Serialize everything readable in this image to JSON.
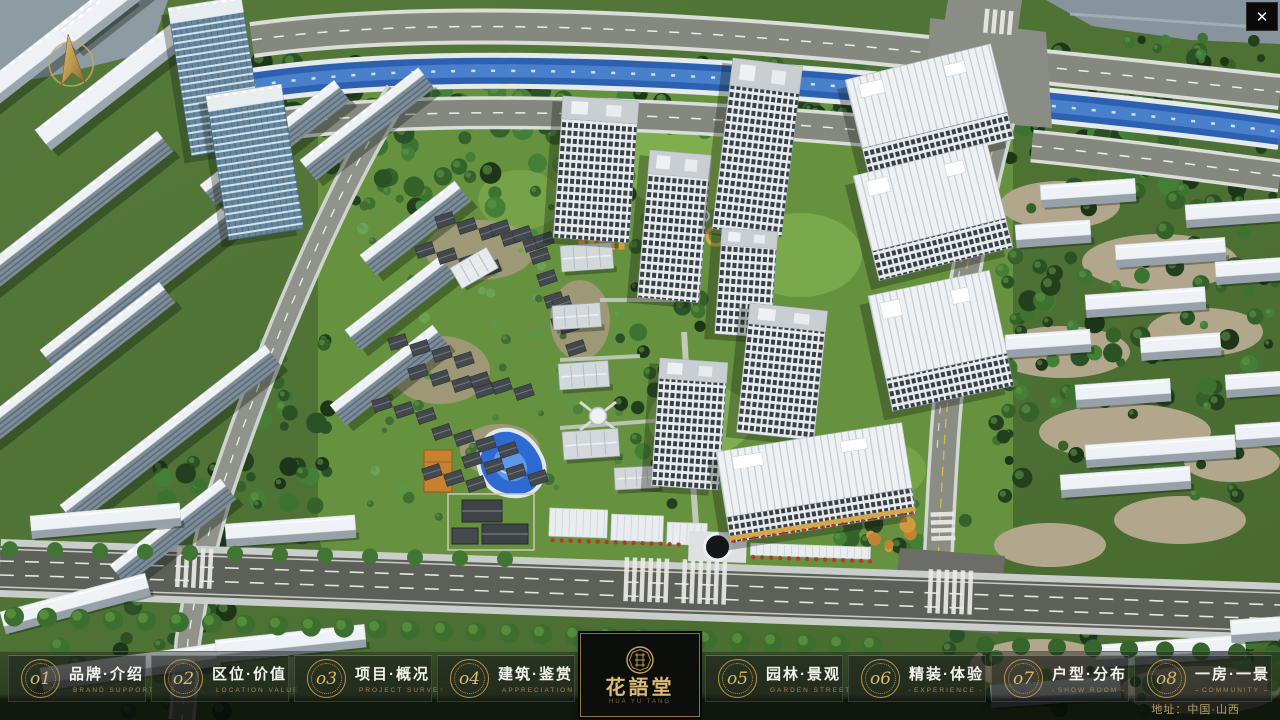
{
  "window": {
    "close_icon": "✕"
  },
  "project": {
    "logo_title": "花語堂",
    "logo_subtitle": "HUA YU TANG",
    "address": "地址：中国·山西"
  },
  "menu": {
    "left": [
      {
        "num": "o1",
        "title": "品牌·介绍",
        "subtitle": "BRAND SUPPORT"
      },
      {
        "num": "o2",
        "title": "区位·价值",
        "subtitle": "LOCATION VALUE"
      },
      {
        "num": "o3",
        "title": "项目·概况",
        "subtitle": "PROJECT SURVEY"
      },
      {
        "num": "o4",
        "title": "建筑·鉴赏",
        "subtitle": "APPRECIATION"
      }
    ],
    "right": [
      {
        "num": "o5",
        "title": "园林·景观",
        "subtitle": "GARDEN STREET"
      },
      {
        "num": "o6",
        "title": "精装·体验",
        "subtitle": "EXPERIENCE"
      },
      {
        "num": "o7",
        "title": "户型·分布",
        "subtitle": "SHOW ROOM"
      },
      {
        "num": "o8",
        "title": "一房·一景",
        "subtitle": "COMMUNITY"
      }
    ]
  },
  "colors": {
    "gold": "#c9a55f",
    "bar_bg": "#101210",
    "river": "#2c61b2",
    "tree_dark": "#2b5226",
    "road": "#5d5f59"
  }
}
